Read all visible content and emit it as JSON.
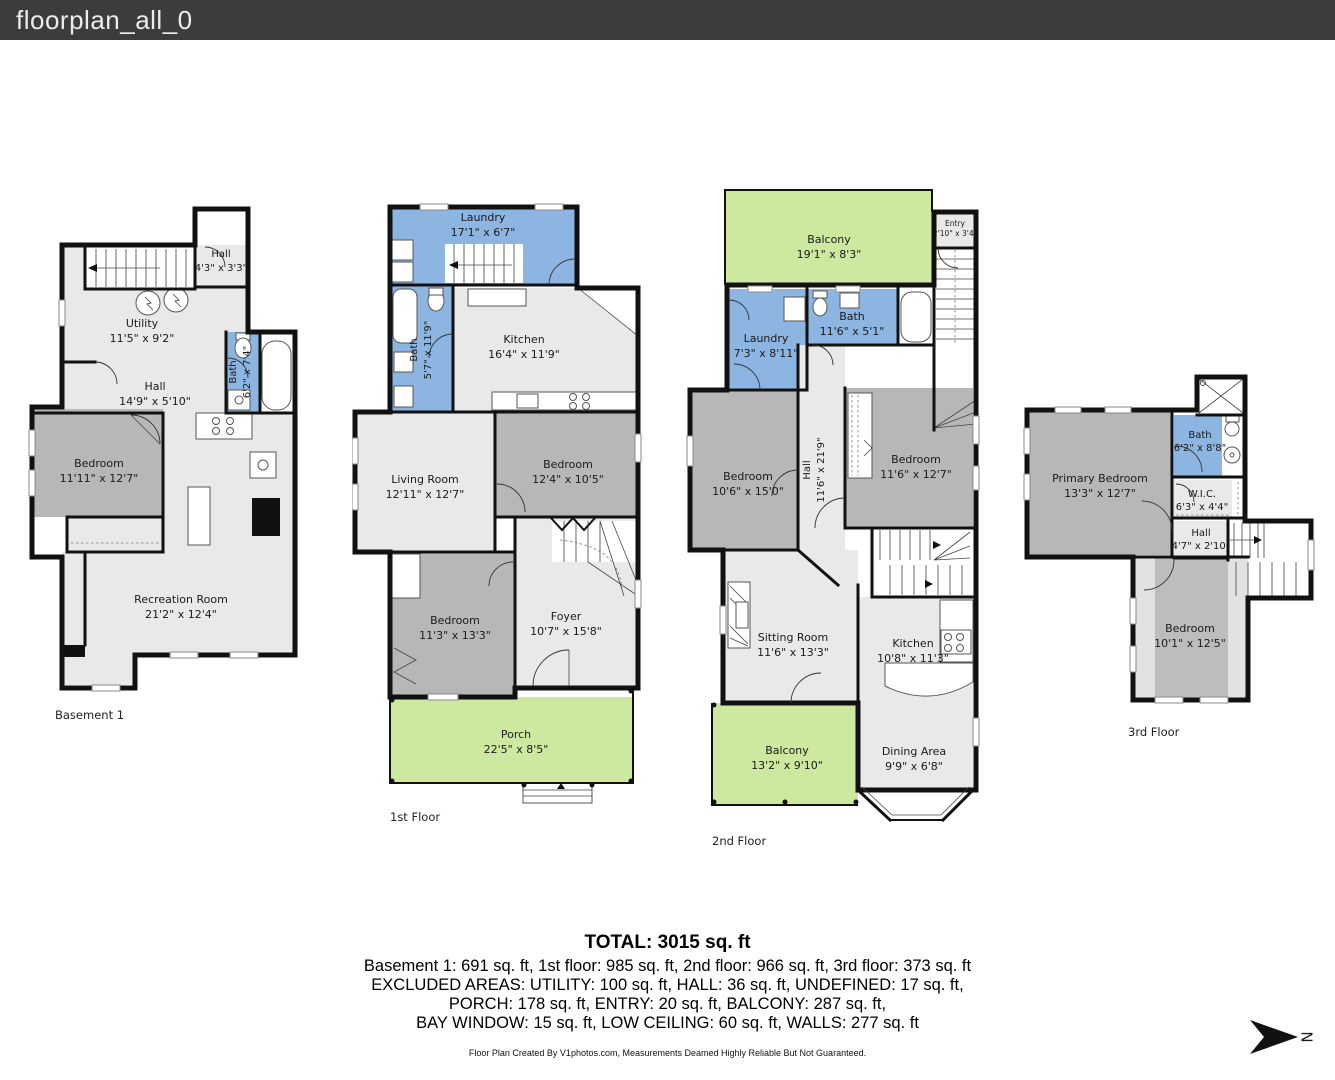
{
  "header": {
    "title": "floorplan_all_0"
  },
  "colors": {
    "header_bg": "#3c3c3c",
    "wall": "#111111",
    "room_light": "#e9e9e9",
    "room_dark": "#b7b7b7",
    "wet_blue": "#8db5e2",
    "outdoor_green": "#cde99f"
  },
  "floors": {
    "basement": {
      "caption": "Basement 1",
      "rooms": {
        "hall_top": {
          "name": "Hall",
          "dims": "4'3\" x 3'3\""
        },
        "utility": {
          "name": "Utility",
          "dims": "11'5\" x 9'2\""
        },
        "hall": {
          "name": "Hall",
          "dims": "14'9\" x 5'10\""
        },
        "bath": {
          "name": "Bath",
          "dims": "6'2\" x 7'4\""
        },
        "bedroom": {
          "name": "Bedroom",
          "dims": "11'11\" x 12'7\""
        },
        "recreation": {
          "name": "Recreation Room",
          "dims": "21'2\" x 12'4\""
        }
      }
    },
    "first": {
      "caption": "1st Floor",
      "rooms": {
        "laundry": {
          "name": "Laundry",
          "dims": "17'1\" x 6'7\""
        },
        "bath": {
          "name": "Bath",
          "dims": "5'7\" x 11'9\""
        },
        "kitchen": {
          "name": "Kitchen",
          "dims": "16'4\" x 11'9\""
        },
        "living": {
          "name": "Living Room",
          "dims": "12'11\" x 12'7\""
        },
        "bedroom1": {
          "name": "Bedroom",
          "dims": "12'4\" x 10'5\""
        },
        "bedroom2": {
          "name": "Bedroom",
          "dims": "11'3\" x 13'3\""
        },
        "foyer": {
          "name": "Foyer",
          "dims": "10'7\" x 15'8\""
        },
        "porch": {
          "name": "Porch",
          "dims": "22'5\" x 8'5\""
        }
      }
    },
    "second": {
      "caption": "2nd Floor",
      "rooms": {
        "balcony_top": {
          "name": "Balcony",
          "dims": "19'1\" x 8'3\""
        },
        "entry": {
          "name": "Entry",
          "dims": "2'10\" x 3'4\""
        },
        "laundry": {
          "name": "Laundry",
          "dims": "7'3\" x 8'11\""
        },
        "bath": {
          "name": "Bath",
          "dims": "11'6\" x 5'1\""
        },
        "hall": {
          "name": "Hall",
          "dims": "11'6\" x 21'9\""
        },
        "bedroom_left": {
          "name": "Bedroom",
          "dims": "10'6\" x 15'0\""
        },
        "bedroom_right": {
          "name": "Bedroom",
          "dims": "11'6\" x 12'7\""
        },
        "sitting": {
          "name": "Sitting Room",
          "dims": "11'6\" x 13'3\""
        },
        "kitchen": {
          "name": "Kitchen",
          "dims": "10'8\" x 11'3\""
        },
        "balcony_bottom": {
          "name": "Balcony",
          "dims": "13'2\" x 9'10\""
        },
        "dining": {
          "name": "Dining Area",
          "dims": "9'9\" x 6'8\""
        }
      }
    },
    "third": {
      "caption": "3rd Floor",
      "rooms": {
        "primary": {
          "name": "Primary Bedroom",
          "dims": "13'3\" x 12'7\""
        },
        "bath": {
          "name": "Bath",
          "dims": "6'2\" x 8'8\""
        },
        "wic": {
          "name": "W.I.C.",
          "dims": "6'3\" x 4'4\""
        },
        "hall": {
          "name": "Hall",
          "dims": "4'7\" x 2'10\""
        },
        "bedroom": {
          "name": "Bedroom",
          "dims": "10'1\" x 12'5\""
        }
      }
    }
  },
  "summary": {
    "total": "TOTAL: 3015 sq. ft",
    "line1": "Basement 1: 691 sq. ft, 1st floor: 985 sq. ft, 2nd floor: 966 sq. ft, 3rd floor: 373 sq. ft",
    "line2": "EXCLUDED AREAS: UTILITY: 100 sq. ft, HALL: 36 sq. ft, UNDEFINED: 17 sq. ft,",
    "line3": "PORCH: 178 sq. ft, ENTRY: 20 sq. ft, BALCONY: 287 sq. ft,",
    "line4": "BAY WINDOW: 15 sq. ft, LOW CEILING: 60 sq. ft, WALLS: 277 sq. ft"
  },
  "footer": {
    "credit": "Floor Plan Created By V1photos.com, Measurements Deamed Highly Reliable But Not Guaranteed."
  },
  "compass": {
    "letter": "N"
  }
}
